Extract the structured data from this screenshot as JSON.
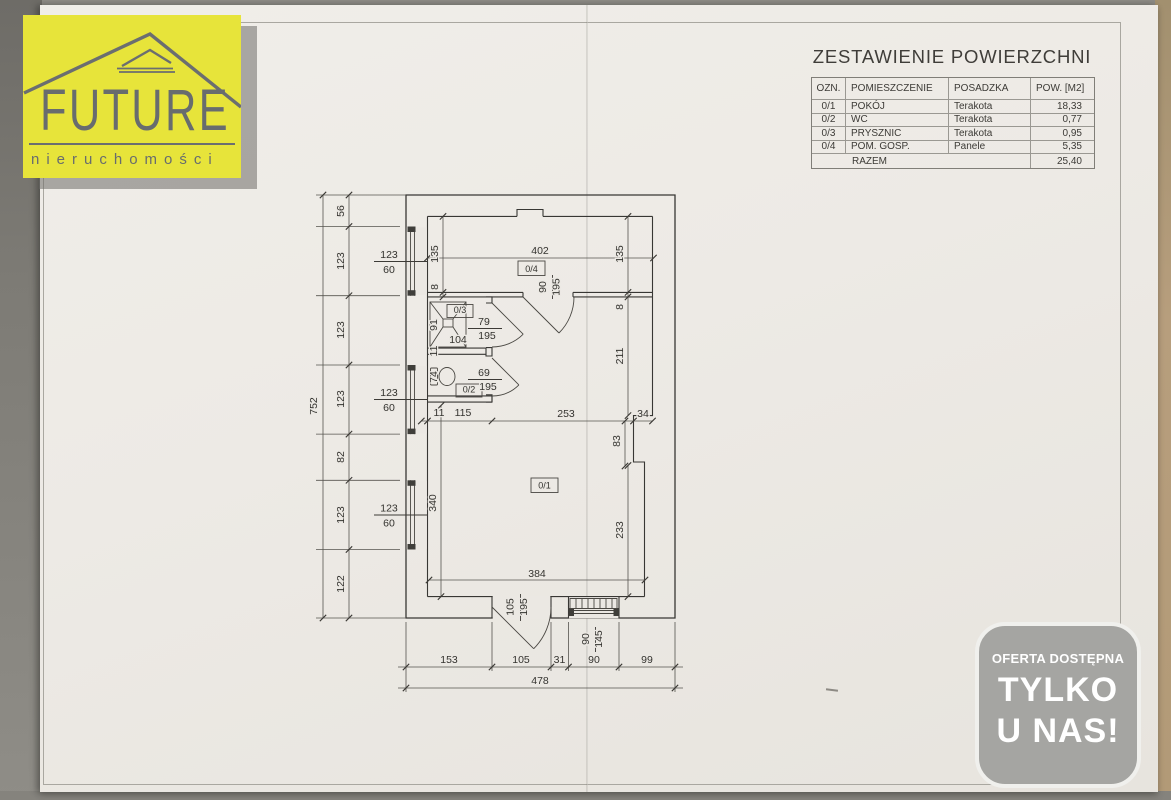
{
  "logo": {
    "brand": "FUTURE",
    "subtitle": "nieruchomości"
  },
  "areas_table": {
    "title": "ZESTAWIENIE POWIERZCHNI",
    "headers": [
      "OZN.",
      "POMIESZCZENIE",
      "POSADZKA",
      "POW. [M2]"
    ],
    "rows": [
      [
        "0/1",
        "POKÓJ",
        "Terakota",
        "18,33"
      ],
      [
        "0/2",
        "WC",
        "Terakota",
        "0,77"
      ],
      [
        "0/3",
        "PRYSZNIC",
        "Terakota",
        "0,95"
      ],
      [
        "0/4",
        "POM. GOSP.",
        "Panele",
        "5,35"
      ]
    ],
    "total_label": "RAZEM",
    "total_value": "25,40"
  },
  "badge": {
    "line1": "OFERTA DOSTĘPNA",
    "line2": "TYLKO",
    "line3": "U NAS!"
  },
  "plan": {
    "rooms": [
      {
        "t": "0/4",
        "x": 531.5,
        "y": 272
      },
      {
        "t": "0/3",
        "x": 460,
        "y": 313
      },
      {
        "t": "0/2",
        "x": 469,
        "y": 392.5
      },
      {
        "t": "0/1",
        "x": 544.5,
        "y": 488.5
      }
    ],
    "labels": [
      {
        "t": "752",
        "x": 317,
        "y": 406,
        "r": -90
      },
      {
        "t": "56",
        "x": 344,
        "y": 211,
        "r": -90
      },
      {
        "t": "123",
        "x": 344,
        "y": 261,
        "r": -90
      },
      {
        "t": "123",
        "x": 344,
        "y": 330,
        "r": -90
      },
      {
        "t": "123",
        "x": 344,
        "y": 399,
        "r": -90
      },
      {
        "t": "82",
        "x": 344,
        "y": 457,
        "r": -90
      },
      {
        "t": "123",
        "x": 344,
        "y": 515,
        "r": -90
      },
      {
        "t": "122",
        "x": 344,
        "y": 584,
        "r": -90
      },
      {
        "t": "123",
        "x": 389,
        "y": 258
      },
      {
        "t": "60",
        "x": 389,
        "y": 273
      },
      {
        "t": "123",
        "x": 389,
        "y": 396
      },
      {
        "t": "60",
        "x": 389,
        "y": 411
      },
      {
        "t": "123",
        "x": 389,
        "y": 511.5
      },
      {
        "t": "60",
        "x": 389,
        "y": 526.5
      },
      {
        "t": "402",
        "x": 540,
        "y": 254
      },
      {
        "t": "135",
        "x": 438,
        "y": 254,
        "r": -90
      },
      {
        "t": "8",
        "x": 438,
        "y": 287,
        "r": -90
      },
      {
        "t": "135",
        "x": 623,
        "y": 254,
        "r": -90
      },
      {
        "t": "8",
        "x": 623,
        "y": 307,
        "r": -90
      },
      {
        "t": "211",
        "x": 623,
        "y": 356,
        "r": -90
      },
      {
        "t": "90",
        "x": 546,
        "y": 287,
        "r": -90
      },
      {
        "t": "195",
        "x": 559.5,
        "y": 287,
        "r": -90
      },
      {
        "t": "91",
        "x": 437,
        "y": 325,
        "r": -90
      },
      {
        "t": "11",
        "x": 437,
        "y": 351,
        "r": -90
      },
      {
        "t": "104",
        "x": 458,
        "y": 343
      },
      {
        "t": "79",
        "x": 484,
        "y": 325
      },
      {
        "t": "195",
        "x": 487,
        "y": 339
      },
      {
        "t": "74",
        "x": 437,
        "y": 377,
        "r": -90
      },
      {
        "t": "69",
        "x": 484,
        "y": 376
      },
      {
        "t": "195",
        "x": 488,
        "y": 390
      },
      {
        "t": "11",
        "x": 439,
        "y": 416
      },
      {
        "t": "115",
        "x": 463,
        "y": 416
      },
      {
        "t": "253",
        "x": 566,
        "y": 417
      },
      {
        "t": "34",
        "x": 643,
        "y": 417
      },
      {
        "t": "83",
        "x": 620,
        "y": 441,
        "r": -90
      },
      {
        "t": "340",
        "x": 436,
        "y": 503,
        "r": -90
      },
      {
        "t": "233",
        "x": 623,
        "y": 530,
        "r": -90
      },
      {
        "t": "384",
        "x": 537,
        "y": 577
      },
      {
        "t": "105",
        "x": 513.5,
        "y": 607,
        "r": -90
      },
      {
        "t": "195",
        "x": 527,
        "y": 607,
        "r": -90
      },
      {
        "t": "90",
        "x": 589,
        "y": 639,
        "r": -90
      },
      {
        "t": "145",
        "x": 602,
        "y": 639,
        "r": -90
      },
      {
        "t": "153",
        "x": 449,
        "y": 663
      },
      {
        "t": "105",
        "x": 521,
        "y": 663
      },
      {
        "t": "31",
        "x": 559.5,
        "y": 663
      },
      {
        "t": "90",
        "x": 594,
        "y": 663
      },
      {
        "t": "99",
        "x": 647,
        "y": 663
      },
      {
        "t": "478",
        "x": 540,
        "y": 684
      }
    ]
  }
}
